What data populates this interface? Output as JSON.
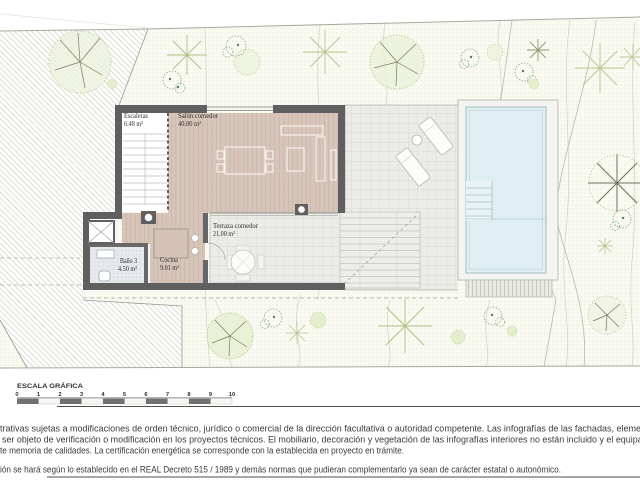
{
  "plan": {
    "rooms": [
      {
        "name": "Escaleras",
        "area": "6.48 m²"
      },
      {
        "name": "Salón comedor",
        "area": "40.00 m²"
      },
      {
        "name": "Terraza comedor",
        "area": "21.00 m²"
      },
      {
        "name": "Baño 3",
        "area": "4.50 m²"
      },
      {
        "name": "Cocina",
        "area": "9.01 m²"
      }
    ]
  },
  "scale_bar": {
    "title": "ESCALA GRÁFICA",
    "ticks": [
      "0",
      "1",
      "2",
      "3",
      "4",
      "5",
      "6",
      "7",
      "8",
      "9",
      "10"
    ]
  },
  "disclaimer": {
    "line1": "trativas sujetas a modificaciones de orden técnico, jurídico o comercial de la dirección facultativa o autoridad competente. Las infografías de las fachadas, elementos",
    "line2": "ser objeto de verificación o modificación en los proyectos técnicos. El mobiliario, decoración y vegetación de las infografías interiores no están incluido y el equipamien",
    "line3": "te memoria de calidades. La certificación energética se corresponde con la establecida en proyecto en trámite.",
    "line4": "ión se hará según lo establecido en el REAL Decreto 515 / 1989 y demás normas que pudieran complementarlo ya sean de carácter estatal o autonómico."
  },
  "colors": {
    "wall": "#5f5f5f",
    "wood_floor": "#d8c6ba",
    "pool_water": "#e0eff3",
    "terrace": "#ebebe7",
    "ground_dot": "#d7e0c8",
    "text": "#3b3b3b"
  }
}
